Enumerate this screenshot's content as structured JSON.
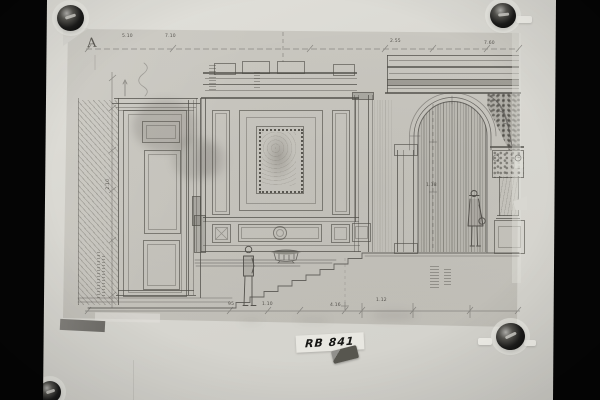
{
  "photo": {
    "archive_label": "RB 841",
    "marker_letter": "A"
  },
  "annotations": {
    "top": [
      "5.10",
      "7.10",
      "2.55",
      "7.60"
    ],
    "left": "2.10",
    "bottom": [
      "95",
      "1.10",
      "4.16",
      "1.12"
    ],
    "arch": "1.18"
  },
  "colors": {
    "photo_border": "#050505",
    "backing_board": "#d8d7d1",
    "drawing_sheet": "#c7c5be",
    "pencil": "#55534e",
    "label_paper": "#e8e7e1",
    "label_ink": "#161614",
    "pin": "#1a1a19",
    "tape": "#716f6a"
  }
}
